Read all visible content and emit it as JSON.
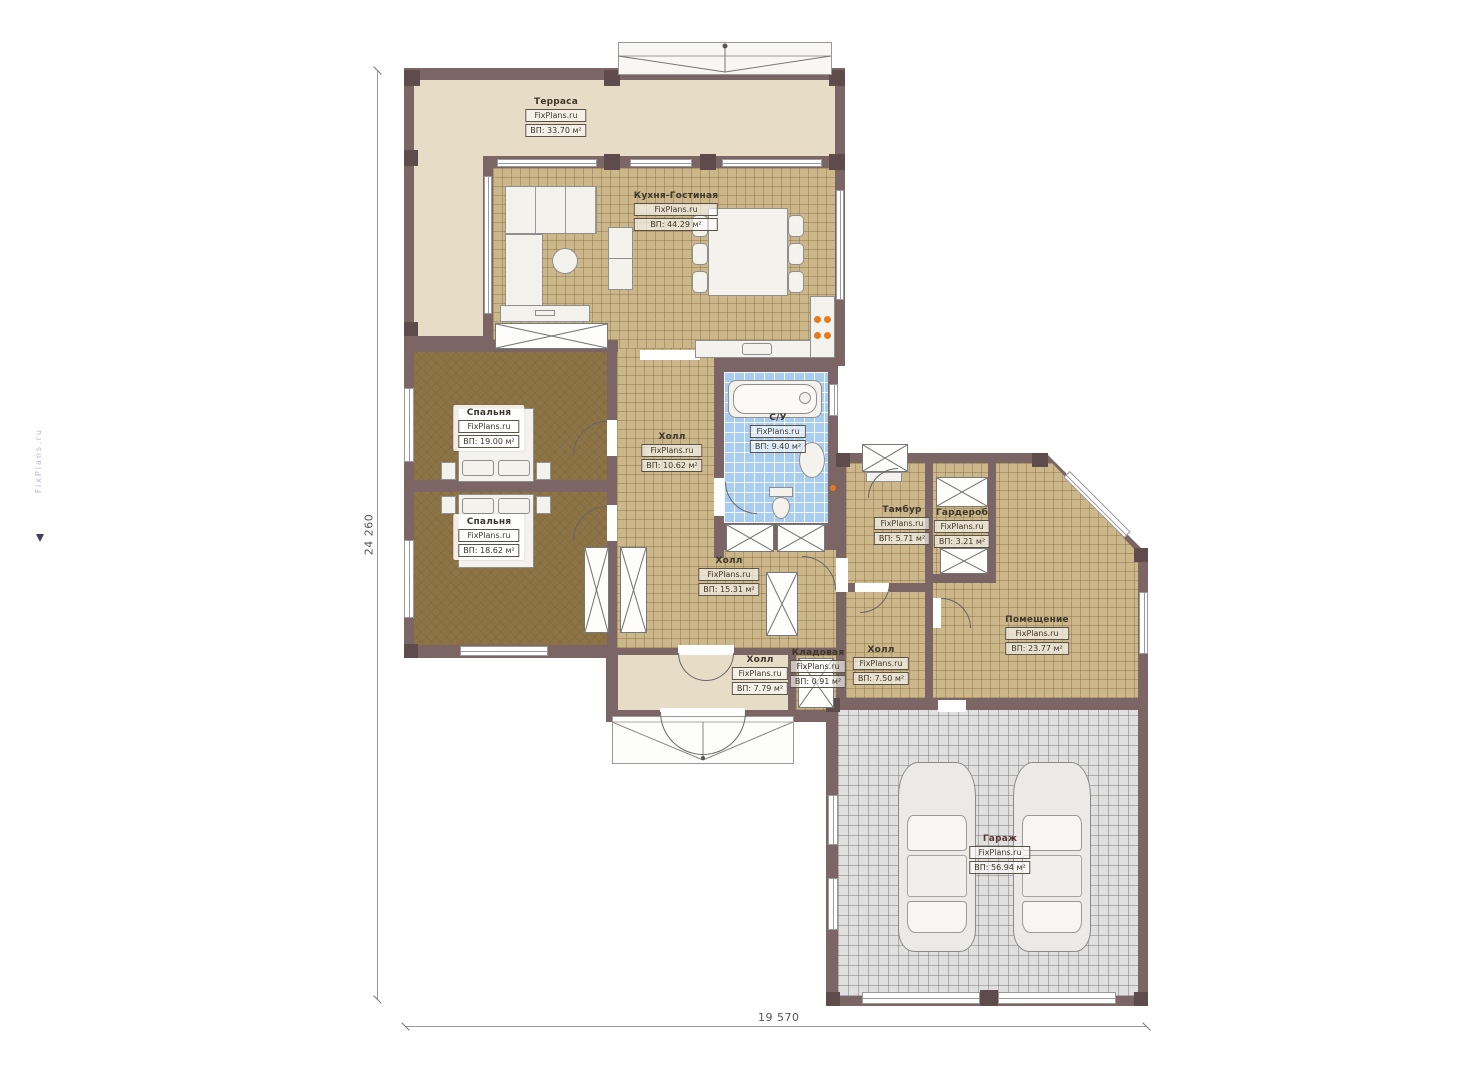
{
  "watermark": "FixPlans.ru",
  "dimensions": {
    "height_mm": "24 260",
    "width_mm": "19 570"
  },
  "rooms": [
    {
      "name": "Терраса",
      "brand": "FixPlans.ru",
      "area": "ВП: 33.70 м²"
    },
    {
      "name": "Кухня-Гостиная",
      "brand": "FixPlans.ru",
      "area": "ВП: 44.29 м²"
    },
    {
      "name": "Спальня",
      "brand": "FixPlans.ru",
      "area": "ВП: 19.00 м²"
    },
    {
      "name": "Спальня",
      "brand": "FixPlans.ru",
      "area": "ВП: 18.62 м²"
    },
    {
      "name": "Холл",
      "brand": "FixPlans.ru",
      "area": "ВП: 10.62 м²"
    },
    {
      "name": "С/У",
      "brand": "FixPlans.ru",
      "area": "ВП: 9.40 м²"
    },
    {
      "name": "Холл",
      "brand": "FixPlans.ru",
      "area": "ВП: 15.31 м²"
    },
    {
      "name": "Тамбур",
      "brand": "FixPlans.ru",
      "area": "ВП: 5.71 м²"
    },
    {
      "name": "Гардероб",
      "brand": "FixPlans.ru",
      "area": "ВП: 3.21 м²"
    },
    {
      "name": "Помещение",
      "brand": "FixPlans.ru",
      "area": "ВП: 23.77 м²"
    },
    {
      "name": "Холл",
      "brand": "FixPlans.ru",
      "area": "ВП: 7.50 м²"
    },
    {
      "name": "Холл",
      "brand": "FixPlans.ru",
      "area": "ВП: 7.79 м²"
    },
    {
      "name": "Кладовая",
      "brand": "FixPlans.ru",
      "area": "ВП: 0.91 м²"
    },
    {
      "name": "Гараж",
      "brand": "FixPlans.ru",
      "area": "ВП: 56.94 м²"
    }
  ],
  "colors": {
    "wall": "#7b6565",
    "tile": "#cbb78a",
    "bedroom_floor": "#8d7446",
    "bathroom_tile": "#a9cdf0",
    "terrace_floor": "#e7ddc7",
    "garage_floor": "#e0e0e0",
    "stove_accent": "#e87a1e"
  }
}
